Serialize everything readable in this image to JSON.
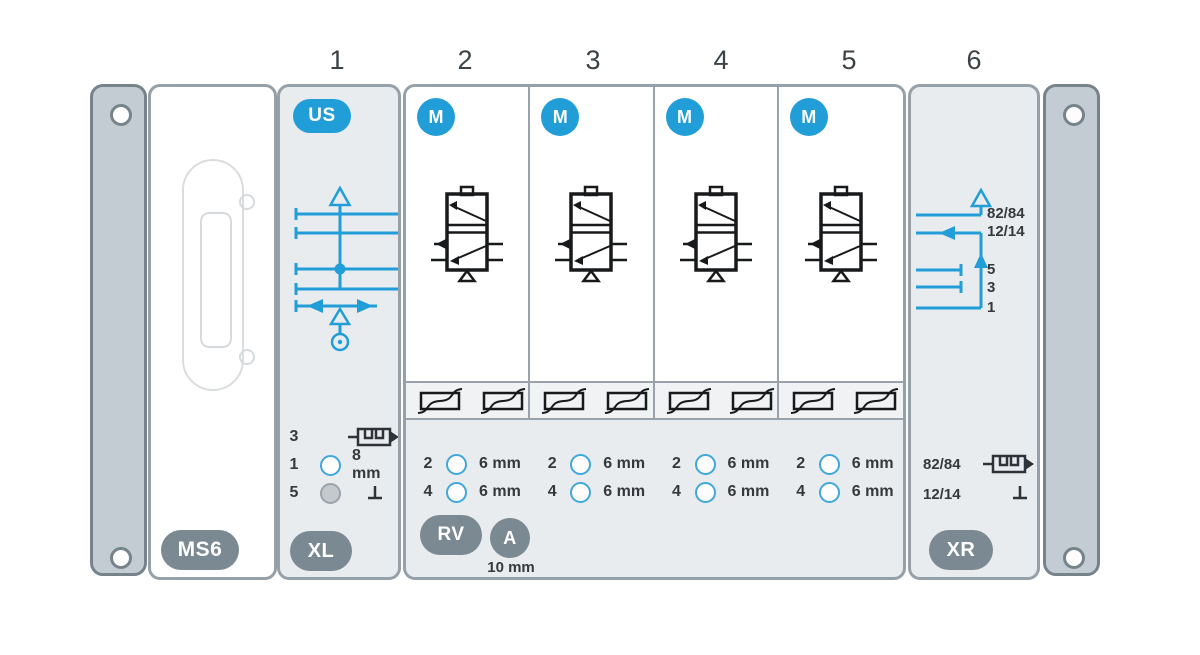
{
  "colors": {
    "accent_blue": "#219dd8",
    "badge_gray": "#7b8992",
    "module_gray": "#e9ecee",
    "endplate_gray": "#c3ccd3",
    "symbol_black": "#17191b",
    "text_dark": "#34393d"
  },
  "top_numbers": [
    "1",
    "2",
    "3",
    "4",
    "5",
    "6"
  ],
  "ms6": {
    "badge": "MS6"
  },
  "us": {
    "badge": "US",
    "bottom_badge": "XL",
    "ports": [
      {
        "num": "3",
        "fitting_icon": "silencer-icon"
      },
      {
        "num": "1",
        "size": "8 mm"
      },
      {
        "num": "5",
        "fitting_icon": "plug-icon"
      }
    ]
  },
  "valves": {
    "slices": [
      {
        "badge": "M",
        "ports": [
          {
            "num": "2",
            "size": "6 mm"
          },
          {
            "num": "4",
            "size": "6 mm"
          }
        ]
      },
      {
        "badge": "M",
        "ports": [
          {
            "num": "2",
            "size": "6 mm"
          },
          {
            "num": "4",
            "size": "6 mm"
          }
        ]
      },
      {
        "badge": "M",
        "ports": [
          {
            "num": "2",
            "size": "6 mm"
          },
          {
            "num": "4",
            "size": "6 mm"
          }
        ]
      },
      {
        "badge": "M",
        "ports": [
          {
            "num": "2",
            "size": "6 mm"
          },
          {
            "num": "4",
            "size": "6 mm"
          }
        ]
      }
    ],
    "rv_badge": "RV",
    "a_badge": "A",
    "a_size": "10 mm"
  },
  "xr": {
    "badge": "XR",
    "schematic_labels": [
      "82/84",
      "12/14",
      "5",
      "3",
      "1"
    ],
    "ports": [
      {
        "num": "82/84",
        "fitting_icon": "silencer-icon"
      },
      {
        "num": "12/14",
        "fitting_icon": "plug-icon"
      }
    ]
  }
}
